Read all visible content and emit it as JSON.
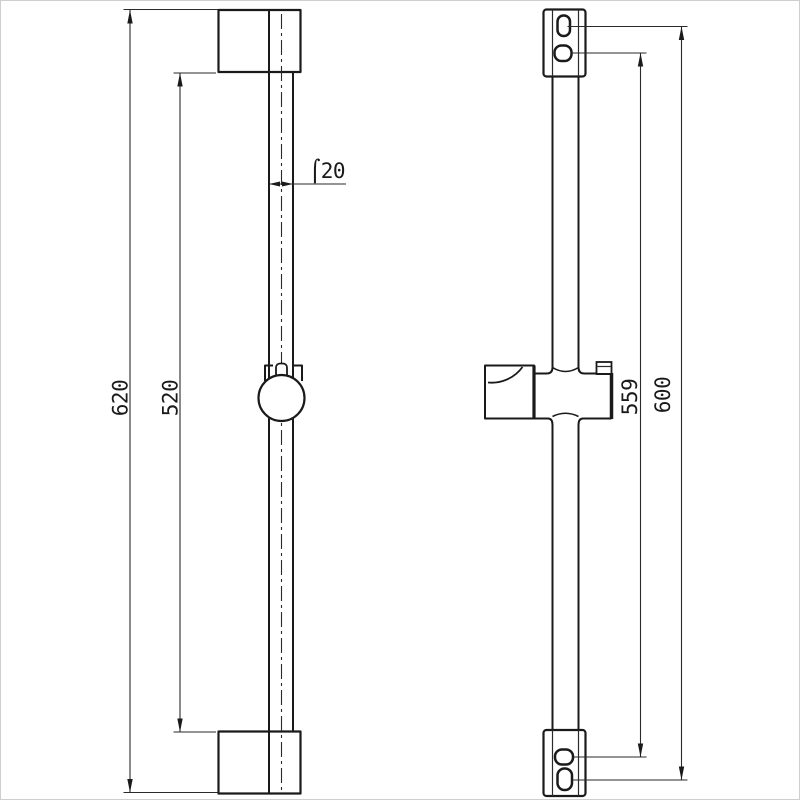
{
  "canvas": {
    "background": "#ffffff",
    "border_color": "#cfcfcf",
    "line_color": "#1a1a1a",
    "dim_color": "#2a2a2a"
  },
  "front_view": {
    "dim_overall": "620",
    "dim_bar": "520",
    "dim_diameter": "⌠20"
  },
  "side_view": {
    "dim_inner_span": "559",
    "dim_outer_span": "600"
  }
}
